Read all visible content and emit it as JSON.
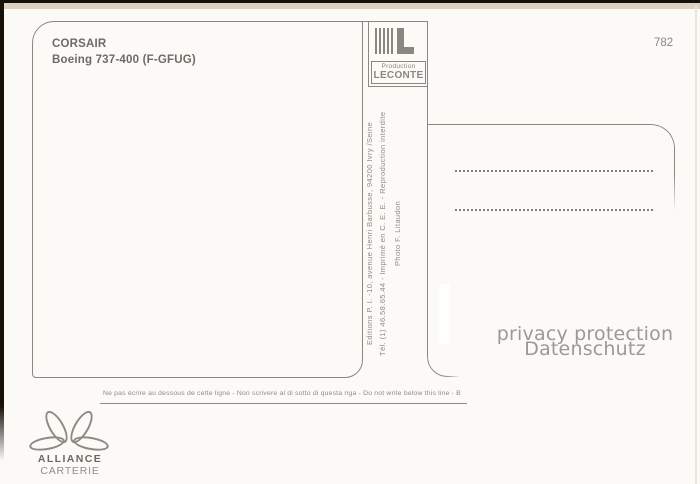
{
  "postcard": {
    "title": "CORSAIR",
    "subtitle": "Boeing 737-400 (F-GFUG)",
    "number": "782"
  },
  "leconte": {
    "label_top": "Production",
    "label_bottom": "LECONTE"
  },
  "imprint": {
    "line1": "Editions P. I. -10, avenue Henri Barbusse, 94200 Ivry /Seine",
    "line2": "Tél. (1) 46.58.65.44 - Imprimé en C. E. E. - Reproduction interdite",
    "line3": "Photo F. Litaudon"
  },
  "watermark": {
    "line1": "privacy protection",
    "line2": "Datenschutz"
  },
  "footer": {
    "no_write_caption": "Ne pas écrire au dessous de cette ligne - Non scrivere al di sotto di questa riga - Do not write below this line - B"
  },
  "brand": {
    "name": "ALLIANCE",
    "tagline": "CARTERIE"
  },
  "colors": {
    "background": "#fbfaf7",
    "line": "#8b8781",
    "title_text": "#6e6a65",
    "imprint_text": "#908c86",
    "watermark_text": "#9b9998",
    "scan_edge": "#16100a",
    "cream_band": "#dbd2c2"
  }
}
